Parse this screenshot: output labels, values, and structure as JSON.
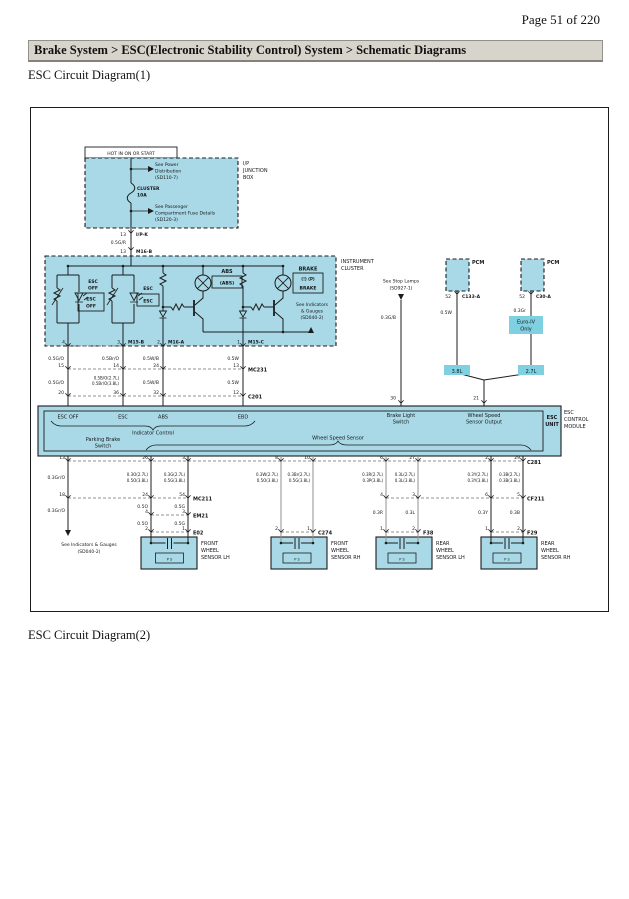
{
  "page": {
    "indicator": "Page 51 of 220",
    "breadcrumb": "Brake System > ESC(Electronic Stability Control) System > Schematic Diagrams",
    "section1_title": "ESC Circuit Diagram(1)",
    "section2_title": "ESC Circuit Diagram(2)"
  },
  "colors": {
    "box_fill": "#a9d9e6",
    "highlight_fill": "#7fd0e0",
    "header_bar": "#d7d4cc",
    "line": "#1c1c1c"
  },
  "d": {
    "hot_label": "HOT IN ON OR START",
    "jb": {
      "ref1_l1": "See Power",
      "ref1_l2": "Distribution",
      "ref1_l3": "(SD110-7)",
      "fuse_name": "CLUSTER",
      "fuse_rating": "10A",
      "ref2_l1": "See Passenger",
      "ref2_l2": "Compartment Fuse Details",
      "ref2_l3": "(SD120-3)",
      "name_l1": "I/P",
      "name_l2": "JUNCTION",
      "name_l3": "BOX",
      "pin_out": "13",
      "conn_out": "I/P-K",
      "wire": "0.5G/R",
      "pin_in": "13",
      "conn_in": "M16-B"
    },
    "cluster": {
      "name_l1": "INSTRUMENT",
      "name_l2": "CLUSTER",
      "escoff_l1": "ESC",
      "escoff_l2": "OFF",
      "escoff_box_l1": "ESC",
      "escoff_box_l2": "OFF",
      "esc_label": "ESC",
      "esc_box": "ESC",
      "abs_label": "ABS",
      "abs_box": "(ABS)",
      "brake_label": "BRAKE",
      "brake_box_l1": "(!) (P)",
      "brake_box_l2": "BRAKE",
      "ref_l1": "See Indicators",
      "ref_l2": "& Gauges",
      "ref_l3": "(SD040-2)",
      "pin1": "4",
      "pin2": "3",
      "conn2": "M15-B",
      "pin3": "2",
      "conn3": "M16-A",
      "pin4": "1",
      "conn4": "M15-C"
    },
    "row_a": [
      "0.5G/O",
      "0.5Br/O",
      "0.5W/B",
      "0.5W"
    ],
    "mc231": {
      "pins": [
        "15",
        "14",
        "24",
        "13"
      ],
      "label": "MC231"
    },
    "row_b": {
      "w1": "0.5G/O",
      "w2a": "0.5B/O(2.7L)",
      "w2b": "0.5Br/O(3.8L)",
      "w3": "0.5W/B",
      "w4": "0.5W"
    },
    "c201": {
      "pins": [
        "20",
        "36",
        "32",
        "12"
      ],
      "label": "C201"
    },
    "pcm": {
      "label": "PCM",
      "pin_left": "52",
      "conn_left": "C133-A",
      "pin_right": "52",
      "conn_right": "C30-A",
      "wire_left": "0.5W",
      "wire_right": "0.3Gr",
      "euro_l1": "Euro-IV",
      "euro_l2": "Only",
      "eng_left": "3.8L",
      "eng_right": "2.7L",
      "pin_in": "21"
    },
    "stop": {
      "l1": "See Stop Lamps",
      "l2": "(SD927-1)",
      "wire": "0.3G/B",
      "pin": "30"
    },
    "esc": {
      "in1": "ESC OFF",
      "in2": "ESC",
      "in3": "ABS",
      "in4": "EBD",
      "indicator_control": "Indicator Control",
      "brake_light_l1": "Brake Light",
      "brake_light_l2": "Switch",
      "wss_out_l1": "Wheel Speed",
      "wss_out_l2": "Sensor Output",
      "parking_l1": "Parking Brake",
      "parking_l2": "Switch",
      "wss_label": "Wheel Speed Sensor",
      "unit_l1": "ESC",
      "unit_l2": "UNIT",
      "module_l1": "ESC",
      "module_l2": "CONTROL",
      "module_l3": "MODULE"
    },
    "c281": {
      "p1": "13",
      "p2": "26",
      "p3": "3",
      "p4": "8",
      "p5": "10",
      "p6": "6",
      "p7": "27",
      "p8": "2",
      "p9": "29",
      "label": "C281"
    },
    "spec": {
      "s13": "0.3Gr/O",
      "fl1a": "0.3O(2.7L)",
      "fl1b": "0.5O(3.8L)",
      "fl2a": "0.3G(2.7L)",
      "fl2b": "0.5G(3.8L)",
      "fr1a": "0.3W(2.7L)",
      "fr1b": "0.5O(3.8L)",
      "fr2a": "0.3Br(2.7L)",
      "fr2b": "0.5G(3.8L)",
      "rl1a": "0.3R(2.7L)",
      "rl1b": "0.3P(3.8L)",
      "rl2a": "0.3L(2.7L)",
      "rl2b": "0.3L(3.8L)",
      "rr1a": "0.3Y(2.7L)",
      "rr1b": "0.3Y(3.8L)",
      "rr2a": "0.3B(2.7L)",
      "rr2b": "0.3B(3.8L)"
    },
    "mc211": {
      "p1": "18",
      "p2": "24",
      "p3": "54",
      "label": "MC211"
    },
    "cf211": {
      "p1": "4",
      "p2": "3",
      "p3": "6",
      "p4": "5",
      "label": "CF211"
    },
    "em21": {
      "p1": "4",
      "p2": "3",
      "label": "EM21"
    },
    "e02": {
      "p1": "2",
      "p2": "1",
      "label": "E02"
    },
    "c274": {
      "p1": "2",
      "p2": "1",
      "label": "C274"
    },
    "f38": {
      "p1": "1",
      "p2": "2",
      "label": "F38"
    },
    "f29": {
      "p1": "1",
      "p2": "2",
      "label": "F29"
    },
    "mid": {
      "w13": "0.3Gr/O",
      "fl1": "0.5O",
      "fl2": "0.5G",
      "fl1b": "0.5O",
      "fl2b": "0.5G",
      "rl1": "0.3R",
      "rl2": "0.3L",
      "rr1": "0.3Y",
      "rr2": "0.3B"
    },
    "gauges_ref": {
      "l1": "See Indicators & Gauges",
      "l2": "(SD040-2)"
    },
    "sensors": {
      "fl_l1": "FRONT",
      "fl_l2": "WHEEL",
      "fl_l3": "SENSOR LH",
      "fr_l1": "FRONT",
      "fr_l2": "WHEEL",
      "fr_l3": "SENSOR RH",
      "rl_l1": "REAR",
      "rl_l2": "WHEEL",
      "rl_l3": "SENSOR LH",
      "rr_l1": "REAR",
      "rr_l2": "WHEEL",
      "rr_l3": "SENSOR RH",
      "mark": "P S"
    }
  }
}
